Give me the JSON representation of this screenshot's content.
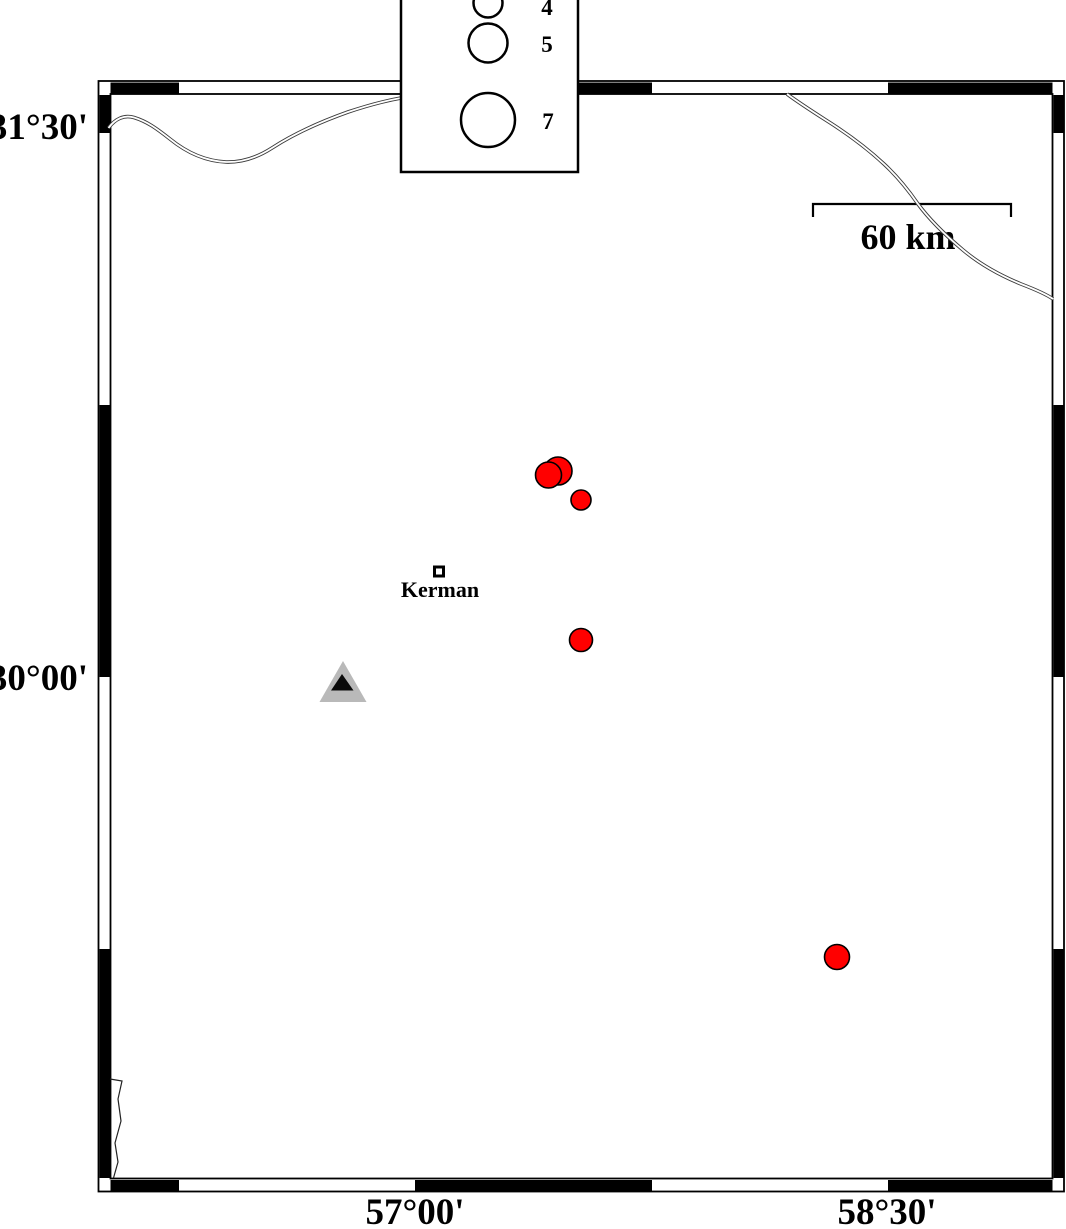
{
  "figure": {
    "type": "seismicity-map",
    "background": "#ffffff"
  },
  "map": {
    "lat_ticks": [
      {
        "label": "31°30'",
        "y_px": 133
      },
      {
        "label": "30°00'",
        "y_px": 677
      }
    ],
    "lon_ticks": [
      {
        "label": "57°00'",
        "x_px": 415
      },
      {
        "label": "58°30'",
        "x_px": 887
      }
    ],
    "scale_bar": {
      "label": "60 km"
    },
    "legend": {
      "items": [
        {
          "label": "4",
          "r": 14.5
        },
        {
          "label": "5",
          "r": 19.5
        },
        {
          "label": "7",
          "r": 27
        }
      ]
    },
    "city": {
      "name": "Kerman",
      "lon": 57.08,
      "lat": 30.29
    },
    "station": {
      "shape": "triangle",
      "lon": 56.77,
      "lat": 29.98
    },
    "earthquakes": [
      {
        "x": 558,
        "y": 471,
        "r": 14,
        "lon": 57.45,
        "lat": 30.57
      },
      {
        "x": 548.5,
        "y": 475,
        "r": 13,
        "lon": 57.43,
        "lat": 30.56
      },
      {
        "x": 581,
        "y": 500,
        "r": 10,
        "lon": 57.53,
        "lat": 30.49
      },
      {
        "x": 581,
        "y": 640,
        "r": 11.5,
        "lon": 57.53,
        "lat": 30.1
      },
      {
        "x": 837,
        "y": 957,
        "r": 12.5,
        "lon": 58.34,
        "lat": 29.23
      }
    ],
    "colors": {
      "earthquake_fill": "#ff0000",
      "station_fill": "#b9b9b9",
      "station_core": "#0a0a0a",
      "frame": "#000000"
    }
  }
}
